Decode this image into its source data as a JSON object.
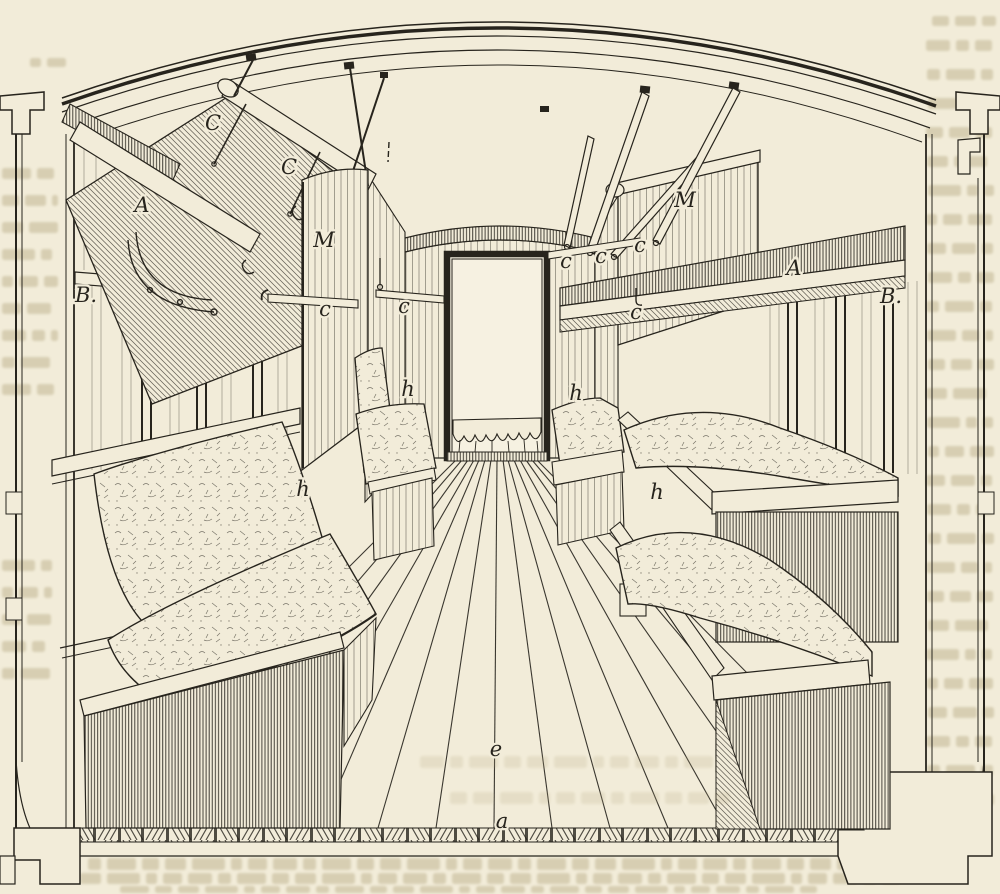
{
  "figure": {
    "palette": {
      "paper": "#f2ecd9",
      "ink": "#27241d",
      "ghost": "#b3a67e"
    },
    "part_labels": [
      {
        "text": "C",
        "x": 213,
        "y": 130
      },
      {
        "text": "C",
        "x": 289,
        "y": 174
      },
      {
        "text": "A",
        "x": 142,
        "y": 212
      },
      {
        "text": "M",
        "x": 324,
        "y": 247
      },
      {
        "text": "B.",
        "x": 86,
        "y": 302
      },
      {
        "text": "c",
        "x": 325,
        "y": 316
      },
      {
        "text": "c",
        "x": 404,
        "y": 313
      },
      {
        "text": "h",
        "x": 408,
        "y": 396
      },
      {
        "text": "h",
        "x": 303,
        "y": 496
      },
      {
        "text": "c",
        "x": 566,
        "y": 268
      },
      {
        "text": "c",
        "x": 601,
        "y": 263
      },
      {
        "text": "c",
        "x": 640,
        "y": 252
      },
      {
        "text": "c",
        "x": 636,
        "y": 319
      },
      {
        "text": "M",
        "x": 685,
        "y": 207
      },
      {
        "text": "A",
        "x": 794,
        "y": 275
      },
      {
        "text": "B.",
        "x": 891,
        "y": 303
      },
      {
        "text": "h",
        "x": 576,
        "y": 400
      },
      {
        "text": "h",
        "x": 657,
        "y": 499
      },
      {
        "text": "e",
        "x": 496,
        "y": 756
      },
      {
        "text": "a",
        "x": 502,
        "y": 828
      }
    ]
  }
}
